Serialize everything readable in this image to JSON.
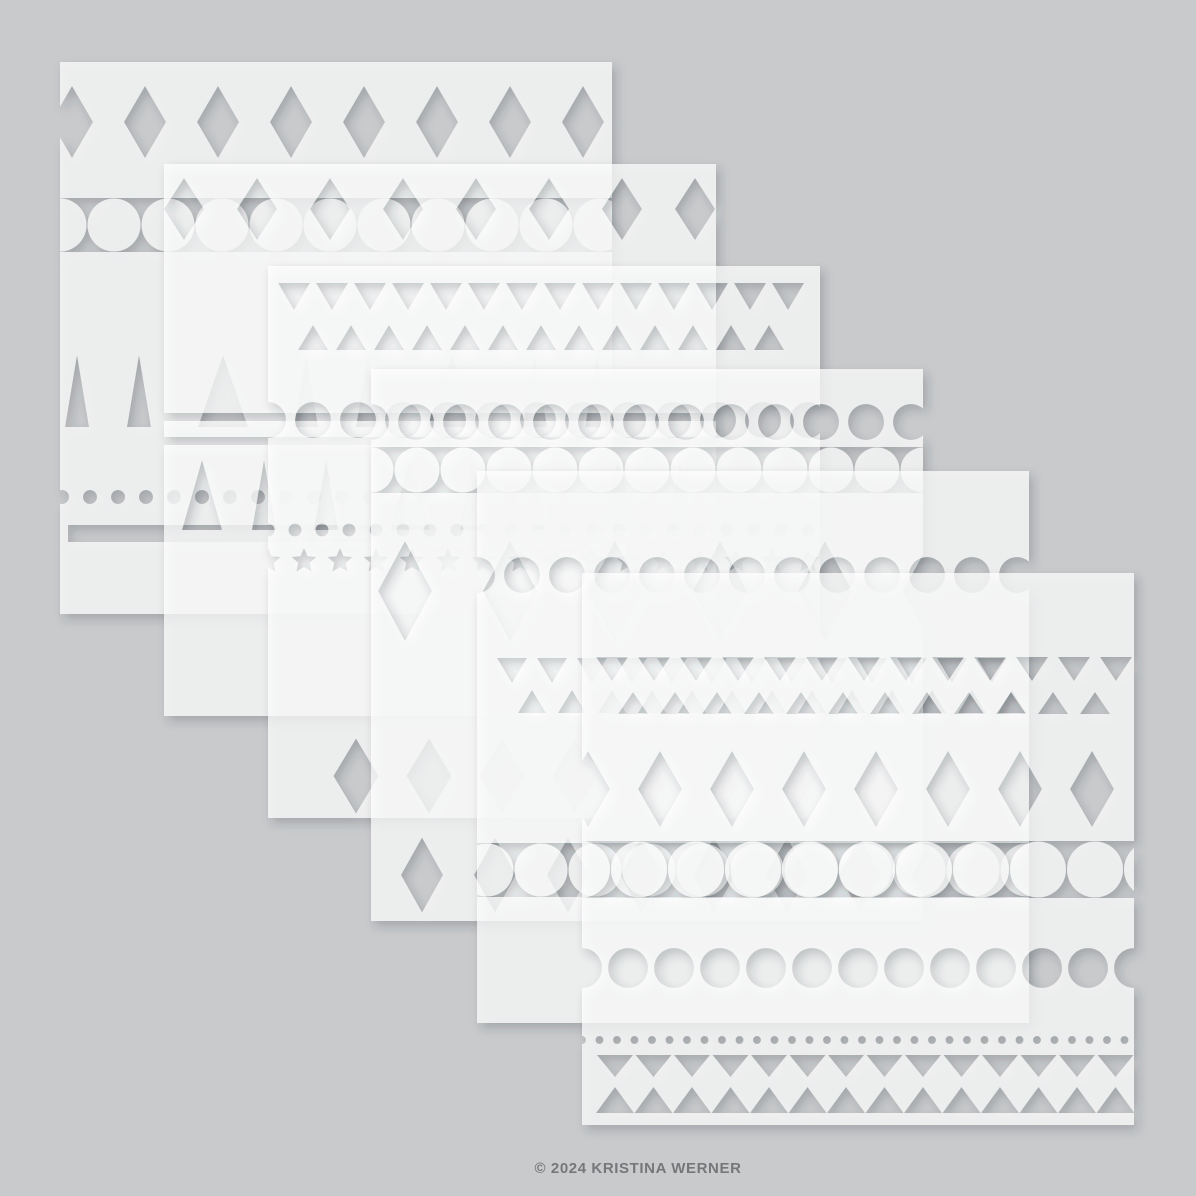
{
  "canvas": {
    "w": 1196,
    "h": 1196
  },
  "palette": {
    "background": "#c9cacc",
    "sheet_white": "#ffffff",
    "copyright_text": "#76777a",
    "shadow_color": "#2f343a"
  },
  "copyright": {
    "text": "© 2024 KRISTINA WERNER"
  },
  "stencil": {
    "sheet": {
      "size": 552,
      "fill": "#ffffff",
      "opacity": 0.72
    },
    "shadow": {
      "dx": 4,
      "dy": 5,
      "blur": 5,
      "color": "#2f343a",
      "opacity": 0.32
    },
    "sheets": [
      {
        "name": "stencil-sheet-1",
        "x": 60,
        "y": 62,
        "bands": [
          {
            "type": "diamonds",
            "cy": 60,
            "w": 42,
            "h": 72,
            "cx0": 12,
            "dx": 73,
            "n": 8
          },
          {
            "type": "beadchain",
            "y0": 136,
            "y1": 190,
            "cx0": 0,
            "dx": 54,
            "n": 11
          },
          {
            "type": "spikes",
            "y": 365,
            "h": 72,
            "items": [
              [
                17,
                24
              ],
              [
                79,
                24
              ],
              [
                163,
                50
              ],
              [
                246,
                24
              ],
              [
                308,
                24
              ],
              [
                392,
                50
              ],
              [
                475,
                24
              ],
              [
                537,
                24
              ]
            ]
          },
          {
            "type": "dots",
            "cy": 435,
            "d": 14,
            "cx0": 2,
            "dx": 28,
            "n": 20
          },
          {
            "type": "bar",
            "x": 8,
            "y": 463,
            "w": 536,
            "h": 17
          }
        ]
      },
      {
        "name": "stencil-sheet-2",
        "x": 164,
        "y": 164,
        "bands": [
          {
            "type": "diamonds",
            "cy": 45,
            "w": 40,
            "h": 62,
            "cx0": 20,
            "dx": 73,
            "n": 8
          },
          {
            "type": "bar",
            "x": 0,
            "y": 249,
            "w": 552,
            "h": 8
          },
          {
            "type": "bar",
            "x": 0,
            "y": 273,
            "w": 552,
            "h": 8
          },
          {
            "type": "spikes",
            "y": 366,
            "h": 70,
            "items": [
              [
                38,
                40
              ],
              [
                100,
                24
              ],
              [
                162,
                24
              ],
              [
                246,
                40
              ],
              [
                308,
                24
              ],
              [
                370,
                24
              ],
              [
                454,
                40
              ],
              [
                516,
                24
              ]
            ]
          }
        ]
      },
      {
        "name": "stencil-sheet-3",
        "x": 268,
        "y": 266,
        "bands": [
          {
            "type": "tri-down",
            "y": 17,
            "w": 32,
            "h": 27,
            "cx0": 26,
            "dx": 38,
            "n": 14
          },
          {
            "type": "tri-up",
            "y": 84,
            "w": 30,
            "h": 25,
            "cx0": 45,
            "dx": 38,
            "n": 13
          },
          {
            "type": "circles",
            "cy": 154,
            "d": 36,
            "cx0": 0,
            "dx": 45,
            "n": 13
          },
          {
            "type": "dots",
            "cy": 264,
            "d": 13,
            "cx0": 0,
            "dx": 27,
            "n": 21
          },
          {
            "type": "stars",
            "cy": 295,
            "r": 13,
            "cx0": 0,
            "dx": 36,
            "n": 16
          },
          {
            "type": "diamonds",
            "cy": 510,
            "w": 45,
            "h": 75,
            "cx0": 88,
            "dx": 73,
            "n": 7
          }
        ]
      },
      {
        "name": "stencil-sheet-4",
        "x": 371,
        "y": 369,
        "bands": [
          {
            "type": "circles",
            "cy": 53,
            "d": 36,
            "cx0": 0,
            "dx": 45,
            "n": 13
          },
          {
            "type": "beadchain",
            "y0": 78,
            "y1": 124,
            "cx0": 0,
            "dx": 46,
            "n": 13
          },
          {
            "type": "diamonds",
            "cy": 222,
            "w": 54,
            "h": 100,
            "cx0": 34,
            "dx": 105,
            "n": 6
          },
          {
            "type": "diamonds",
            "cy": 506,
            "w": 42,
            "h": 75,
            "cx0": 51,
            "dx": 73,
            "n": 8
          }
        ]
      },
      {
        "name": "stencil-sheet-5",
        "x": 477,
        "y": 471,
        "bands": [
          {
            "type": "circles",
            "cy": 104,
            "d": 36,
            "cx0": 0,
            "dx": 45,
            "n": 13
          },
          {
            "type": "tri-down",
            "y": 187,
            "w": 30,
            "h": 25,
            "cx0": 35,
            "dx": 40,
            "n": 13
          },
          {
            "type": "tri-up",
            "y": 242,
            "w": 28,
            "h": 23,
            "cx0": 55,
            "dx": 40,
            "n": 13
          },
          {
            "type": "beadchain",
            "y0": 372,
            "y1": 426,
            "cx0": 10,
            "dx": 54,
            "n": 11
          }
        ]
      },
      {
        "name": "stencil-sheet-6",
        "x": 582,
        "y": 573,
        "bands": [
          {
            "type": "tri-down",
            "y": 84,
            "w": 32,
            "h": 24,
            "cx0": 30,
            "dx": 42,
            "n": 13
          },
          {
            "type": "tri-up",
            "y": 141,
            "w": 30,
            "h": 22,
            "cx0": 51,
            "dx": 42,
            "n": 12
          },
          {
            "type": "diamonds",
            "cy": 216,
            "w": 44,
            "h": 76,
            "cx0": 6,
            "dx": 72,
            "n": 8
          },
          {
            "type": "beadchain",
            "y0": 268,
            "y1": 325,
            "cx0": 0,
            "dx": 57,
            "n": 11
          },
          {
            "type": "circles",
            "cy": 395,
            "d": 40,
            "cx0": 0,
            "dx": 46,
            "n": 13
          },
          {
            "type": "dots",
            "cy": 467,
            "d": 8,
            "cx0": 0,
            "dx": 17.5,
            "n": 32
          },
          {
            "type": "tri-down",
            "y": 482,
            "w": 36,
            "h": 22,
            "cx0": 33,
            "dx": 38.5,
            "n": 14
          },
          {
            "type": "tri-up",
            "y": 540,
            "w": 38,
            "h": 26,
            "cx0": 33,
            "dx": 38.5,
            "n": 14
          }
        ]
      }
    ]
  }
}
